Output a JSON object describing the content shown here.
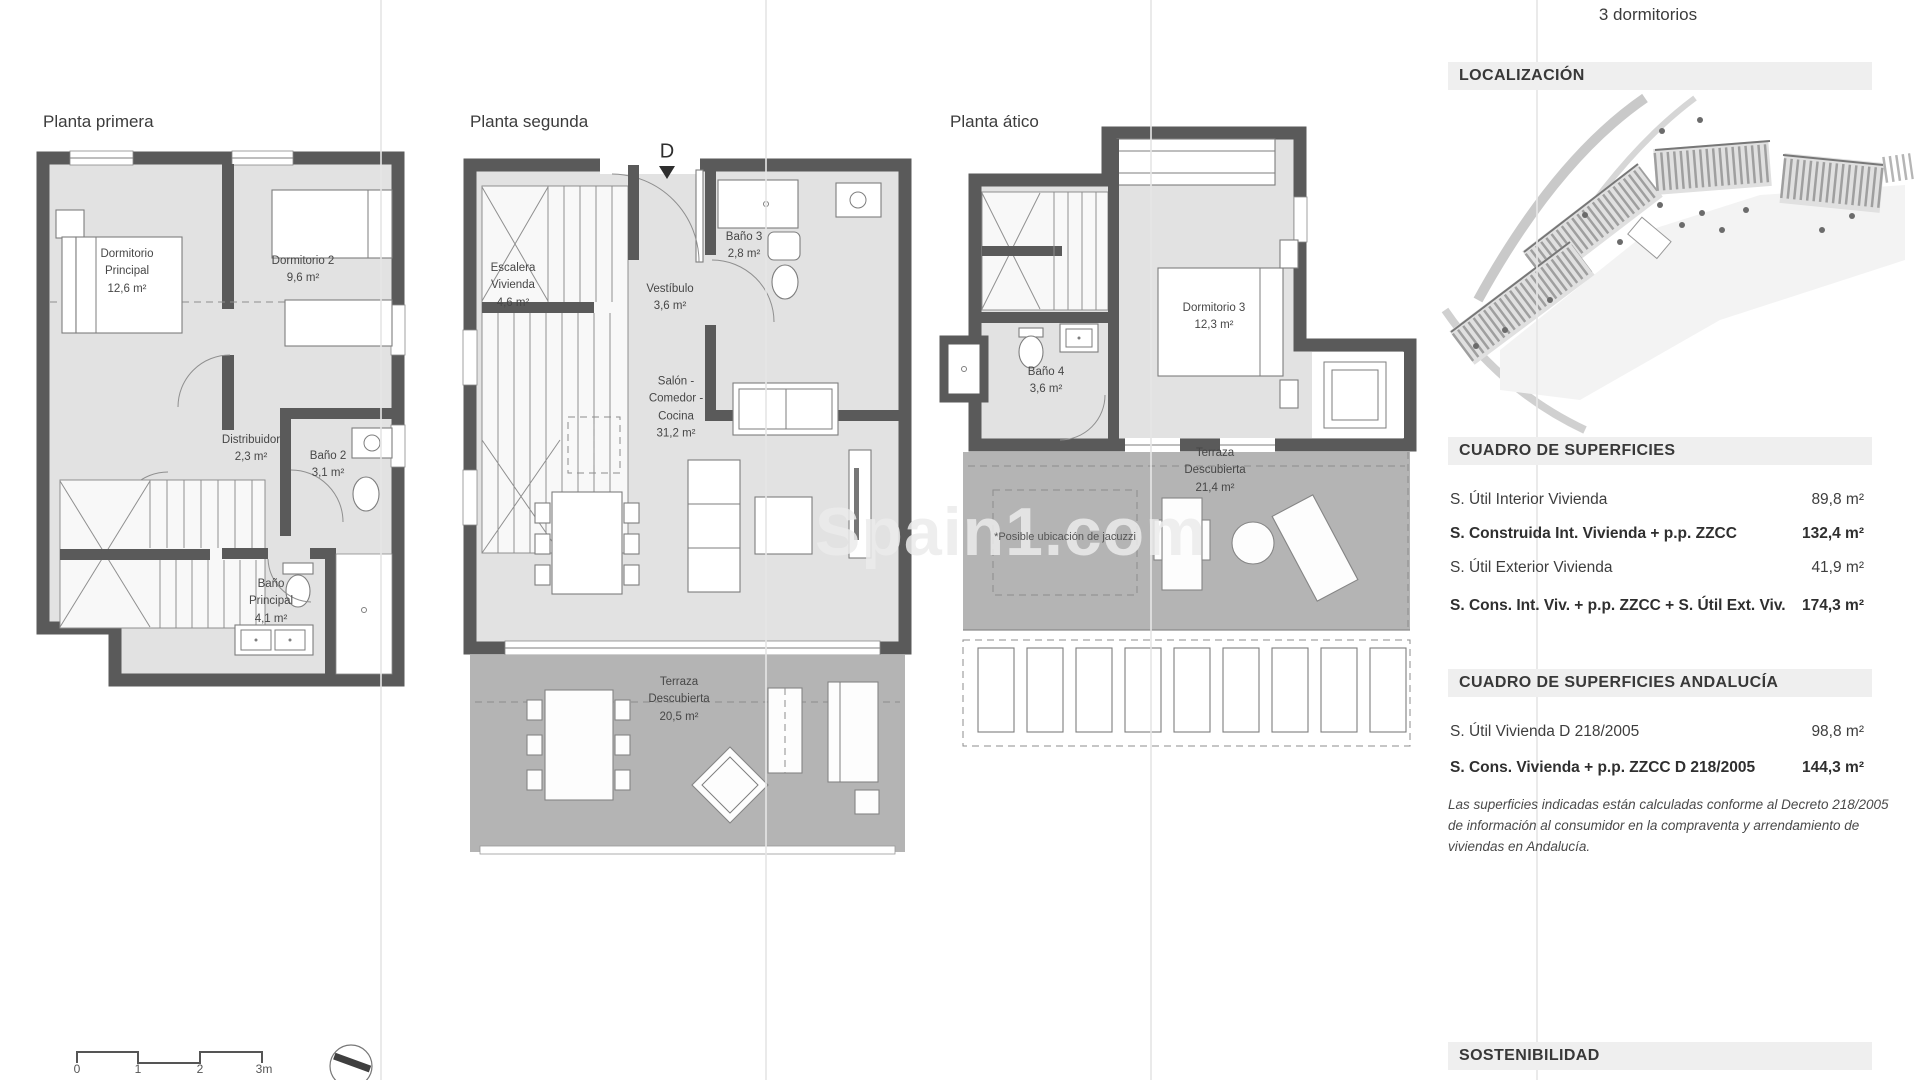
{
  "page": {
    "unit_header": "3 dormitorios"
  },
  "watermark": "Spain1.com",
  "plans": {
    "primera": {
      "title": "Planta primera",
      "rooms": {
        "dormitorio_principal": "Dormitorio\nPrincipal\n12,6 m²",
        "dormitorio2": "Dormitorio 2\n9,6 m²",
        "distribuidor": "Distribuidor\n2,3 m²",
        "bano2": "Baño 2\n3,1 m²",
        "bano_principal": "Baño\nPrincipal\n4,1 m²"
      }
    },
    "segunda": {
      "title": "Planta segunda",
      "section_marker": "D",
      "rooms": {
        "escalera": "Escalera\nVivienda\n4,6 m²",
        "bano3": "Baño 3\n2,8 m²",
        "vestibulo": "Vestíbulo\n3,6 m²",
        "salon": "Salón -\nComedor -\nCocina\n31,2 m²",
        "terraza": "Terraza\nDescubierta\n20,5 m²"
      }
    },
    "atico": {
      "title": "Planta ático",
      "rooms": {
        "dormitorio3": "Dormitorio 3\n12,3 m²",
        "bano4": "Baño 4\n3,6 m²",
        "terraza": "Terraza\nDescubierta\n21,4 m²",
        "jacuzzi_note": "*Posible ubicación de jacuzzi"
      }
    }
  },
  "sidebar": {
    "localizacion_title": "LOCALIZACIÓN",
    "superficies": {
      "title": "CUADRO DE SUPERFICIES",
      "rows": [
        {
          "label": "S. Útil Interior Vivienda",
          "value": "89,8 m²"
        },
        {
          "label": "S. Construida Int. Vivienda + p.p. ZZCC",
          "value": "132,4 m²"
        },
        {
          "label": "S. Útil Exterior Vivienda",
          "value": "41,9 m²"
        },
        {
          "label": "S. Cons. Int. Viv. + p.p. ZZCC + S. Útil Ext. Viv.",
          "value": "174,3 m²"
        }
      ]
    },
    "superficies_andalucia": {
      "title": "CUADRO DE SUPERFICIES ANDALUCÍA",
      "rows": [
        {
          "label": "S. Útil Vivienda D 218/2005",
          "value": "98,8 m²"
        },
        {
          "label": "S. Cons. Vivienda + p.p. ZZCC D 218/2005",
          "value": "144,3 m²"
        }
      ]
    },
    "legal_note": "Las superficies indicadas están calculadas conforme al Decreto 218/2005 de información al consumidor en la compraventa y arrendamiento de viviendas en Andalucía.",
    "sostenibilidad_title": "SOSTENIBILIDAD"
  },
  "scale_bar": {
    "labels": [
      "0",
      "1",
      "2",
      "3m"
    ]
  },
  "colors": {
    "wall": "#5a5a5a",
    "floor": "#e2e2e2",
    "terrace": "#b4b4b4",
    "header_bar": "#efefef",
    "text": "#3f3f3f"
  }
}
